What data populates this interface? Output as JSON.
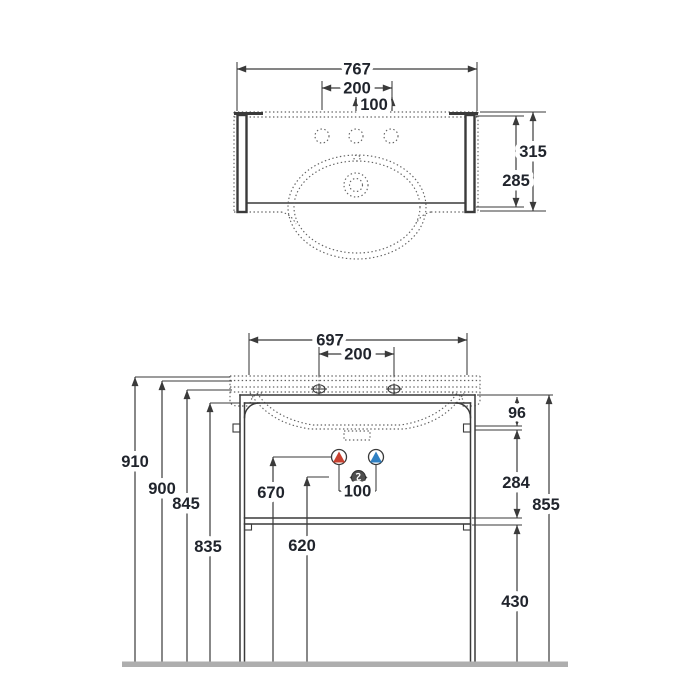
{
  "drawing_title": "washbasin-console-technical-drawing",
  "plan": {
    "dims": {
      "overall_width": "767",
      "tap_spacing": "200",
      "tap_offset": "100",
      "depth_total": "315",
      "depth_top": "285"
    }
  },
  "front": {
    "dims": {
      "frame_width": "697",
      "tap_spacing": "200",
      "supply_spacing": "100",
      "total_height": "910",
      "rim_height": "900",
      "underside_height": "845",
      "frame_top_height": "835",
      "supply_height": "670",
      "waste_height": "620",
      "rail_drop": "96",
      "rail_to_shelf": "284",
      "console_height": "855",
      "shelf_height": "430"
    },
    "symbols": {
      "hot_color": "#c8402f",
      "cold_color": "#2f80c3",
      "waste_color": "#4f4f4f"
    }
  },
  "style": {
    "line_color": "#3a3a3a",
    "floor_color": "#aeaeae",
    "background": "#ffffff"
  }
}
